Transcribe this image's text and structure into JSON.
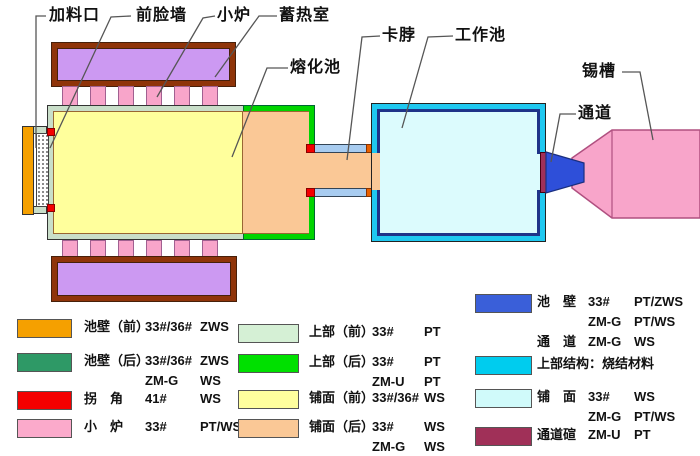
{
  "diagram": {
    "labels": {
      "feed_port": "加料口",
      "front_wall": "前脸墙",
      "small_furnace": "小炉",
      "regenerator": "蓄热室",
      "melting_tank": "熔化池",
      "neck": "卡脖",
      "working_tank": "工作池",
      "tin_bath": "锡槽",
      "channel": "通道"
    }
  },
  "colors": {
    "regenerator_fill": "#cc99f2",
    "regenerator_border": "#8f3409",
    "port_pink": "#f8a5ca",
    "tank_front_band": "#c9dec9",
    "tank_rear_band": "#00d400",
    "melt_front": "#ffff9c",
    "melt_rear": "#fac896",
    "feed_wall_orange": "#f5a000",
    "corner_red": "#f40000",
    "neck_wall_blue": "#a8ccf0",
    "neck_end_orange": "#e86000",
    "work_outer_cyan": "#1fc8f0",
    "work_inner_navy": "#1f3388",
    "work_fill": "#dcfbfd",
    "channel_blue": "#2e4fd9",
    "channel_arch_maroon": "#a03058",
    "tin_bath_pink": "#f8a5ca"
  },
  "legend": {
    "left": [
      {
        "color": "#f5a000",
        "lines": [
          {
            "n": "池壁（前）",
            "a": "33#/36#",
            "b": "ZWS"
          }
        ]
      },
      {
        "color": "#2e9966",
        "lines": [
          {
            "n": "池壁（后）",
            "a": "33#/36#",
            "b": "ZWS"
          },
          {
            "n": "",
            "a": "ZM-G",
            "b": "WS"
          }
        ]
      },
      {
        "color": "#f40000",
        "lines": [
          {
            "n": "拐　角",
            "a": "41#",
            "b": "WS"
          }
        ]
      },
      {
        "color": "#fbaacb",
        "lines": [
          {
            "n": "小　炉",
            "a": "33#",
            "b": "PT/WS"
          }
        ]
      }
    ],
    "middle": [
      {
        "color": "#d5f0d5",
        "lines": [
          {
            "n": "上部（前）",
            "a": "33#",
            "b": "PT"
          }
        ]
      },
      {
        "color": "#00e000",
        "lines": [
          {
            "n": "上部（后）",
            "a": "33#",
            "b": "PT"
          },
          {
            "n": "",
            "a": "ZM-U",
            "b": "PT"
          }
        ]
      },
      {
        "color": "#ffff9e",
        "lines": [
          {
            "n": "铺面（前）",
            "a": "33#/36#",
            "b": "WS"
          }
        ]
      },
      {
        "color": "#fac896",
        "lines": [
          {
            "n": "铺面（后）",
            "a": "33#",
            "b": "WS"
          },
          {
            "n": "",
            "a": "ZM-G",
            "b": "WS"
          }
        ]
      }
    ],
    "right": [
      {
        "color": "#3a5fd9",
        "lines": [
          {
            "n": "池　壁",
            "a": "33#",
            "b": "PT/ZWS"
          },
          {
            "n": "",
            "a": "ZM-G",
            "b": "PT/WS"
          },
          {
            "n": "通　道",
            "a": "ZM-G",
            "b": "WS"
          }
        ]
      },
      {
        "color": "#00ccee",
        "lines": [
          {
            "n": "上部结构：烧结材料",
            "a": "",
            "b": ""
          }
        ]
      },
      {
        "color": "#d0fafa",
        "lines": [
          {
            "n": "铺　面",
            "a": "33#",
            "b": "WS"
          },
          {
            "n": "",
            "a": "ZM-G",
            "b": "PT/WS"
          }
        ]
      },
      {
        "color": "#a03058",
        "lines": [
          {
            "n": "通道碹",
            "a": "ZM-U",
            "b": "PT"
          }
        ]
      }
    ]
  }
}
